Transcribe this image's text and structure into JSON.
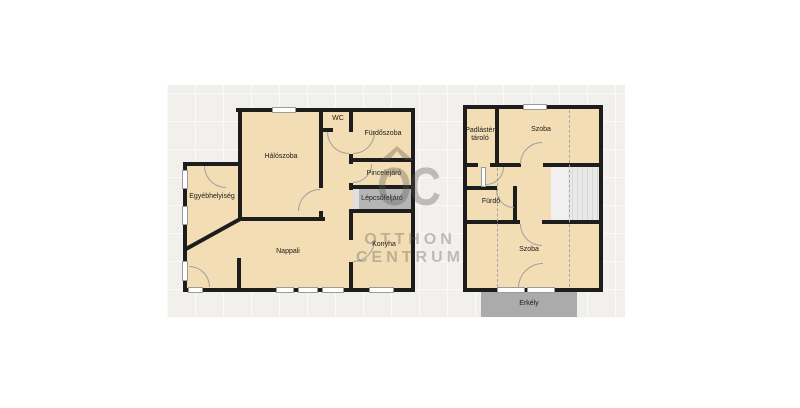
{
  "rooms": {
    "wc": "WC",
    "furdoszoba": "Fürdőszoba",
    "haloszoba": "Hálószoba",
    "pincelejaro": "Pincelejáró",
    "lepcsofeljaro": "Lépcsőfeljáró",
    "egyebhelyiseg": "Egyébhelyiség",
    "nappali": "Nappali",
    "konyha": "Konyha",
    "padlaster_tarolo": "Padlástér tároló",
    "szoba_felso": "Szoba",
    "furdo": "Fürdő",
    "szoba_also": "Szoba",
    "erkely": "Erkély"
  },
  "watermark": {
    "logo": "OC",
    "brand_line1": "OTTHON",
    "brand_line2": "CENTRUM"
  },
  "colors": {
    "room_fill": "#f3ddb4",
    "wall": "#1d1d1d",
    "window_frame": "#9b9b9b",
    "door_arc": "#a0a0a0",
    "staircase_hall": "#b5b5b5",
    "stairs": "#e9e9e9",
    "balcony": "#ababab",
    "grid_background": "#f1f0ec",
    "grid_line": "#fbfaf6",
    "watermark_gray": "#5a5852"
  }
}
